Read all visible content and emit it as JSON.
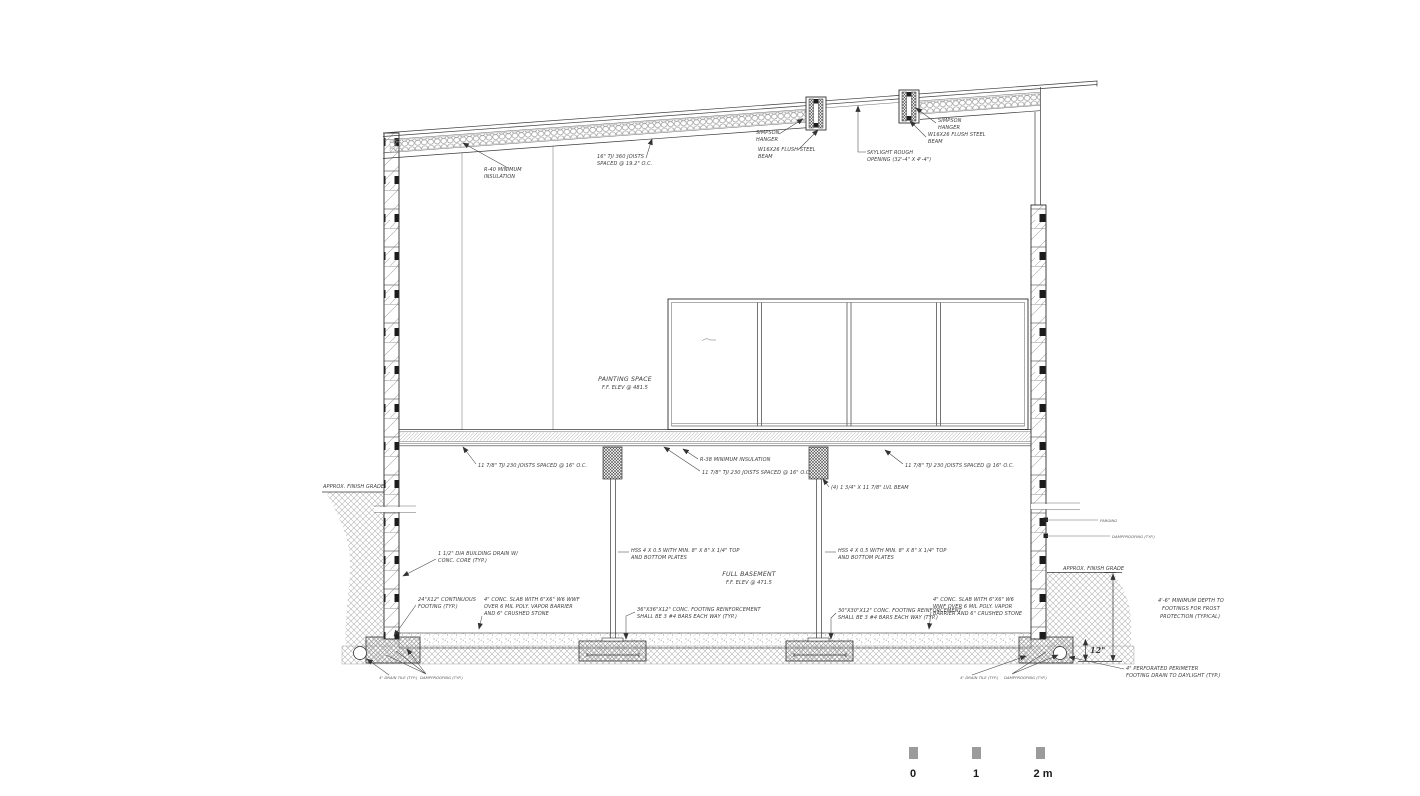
{
  "drawing_type": "architectural building cross-section",
  "t": {
    "grade_l": "APPROX. FINISH GRADE",
    "grade_r": "APPROX. FINISH GRADE",
    "roof_insul1": "R-40 MINIMUM",
    "roof_insul2": "INSULATION",
    "roof_joists1": "16\" TJI 360 JOISTS",
    "roof_joists2": "SPACED @ 19.2\" O.C.",
    "hanger1": "SIMPSON",
    "hanger2": "HANGER",
    "beam1": "W16X26 FLUSH STEEL",
    "beam2": "BEAM",
    "sky1": "SKYLIGHT ROUGH",
    "sky2": "OPENING (32'-4\" X 4'-4\")",
    "paint1": "PAINTING SPACE",
    "paint2": "F.F. ELEV @ 481.5",
    "base1": "FULL BASEMENT",
    "base2": "F.F. ELEV @ 471.5",
    "fjoist": "11 7/8\" TJI 230 JOISTS SPACED @ 16\" O.C.",
    "finsul": "R-38 MINIMUM INSULATION",
    "lvl": "(4) 1 3/4\" X 11 7/8\" LVL BEAM",
    "hss1": "HSS 4 X 0.5 WITH MIN. 8\" X 8\" X 1/4\" TOP",
    "hss2": "AND BOTTOM PLATES",
    "drain1": "1 1/2\" DIA BUILDING DRAIN W/",
    "drain2": "CONC. CORE (TYP.)",
    "cfoot1": "24\"X12\" CONTINUOUS",
    "cfoot2": "FOOTING (TYP.)",
    "slabL1": "4\" CONC. SLAB WITH 6\"X6\" W6 WWF",
    "slabL2": "OVER 6 MIL POLY. VAPOR BARRIER",
    "slabL3": "AND 6\" CRUSHED STONE",
    "slabR1": "4\" CONC. SLAB WITH 6\"X6\" W6",
    "slabR2": "WWF OVER 6 MIL POLY. VAPOR",
    "slabR3": "BARRIER AND 6\" CRUSHED STONE",
    "ftgL1": "36\"X36\"X12\" CONC. FOOTING REINFORCEMENT",
    "ftgL2": "SHALL BE 3 #4 BARS EACH WAY (TYP.)",
    "ftgR1": "30\"X30\"X12\" CONC. FOOTING REINFORCEMENT",
    "ftgR2": "SHALL BE 3 #4 BARS EACH WAY (TYP.)",
    "frost1": "4'-6\" MINIMUM DEPTH TO",
    "frost2": "FOOTINGS FOR FROST",
    "frost3": "PROTECTION (TYPICAL)",
    "dim12": "12\"",
    "perim1": "4\" PERFORATED PERIMETER",
    "perim2": "FOOTING DRAIN TO DAYLIGHT (TYP.)",
    "tinyA": "4\" DRAIN TILE (TYP.)",
    "tinyB": "DAMPPROOFING (TYP.)",
    "wallA": "PARGING",
    "wallB": "DAMPPROOFING (TYP.)"
  },
  "scale_bar": {
    "ticks": [
      "0",
      "1",
      "2 m"
    ]
  }
}
